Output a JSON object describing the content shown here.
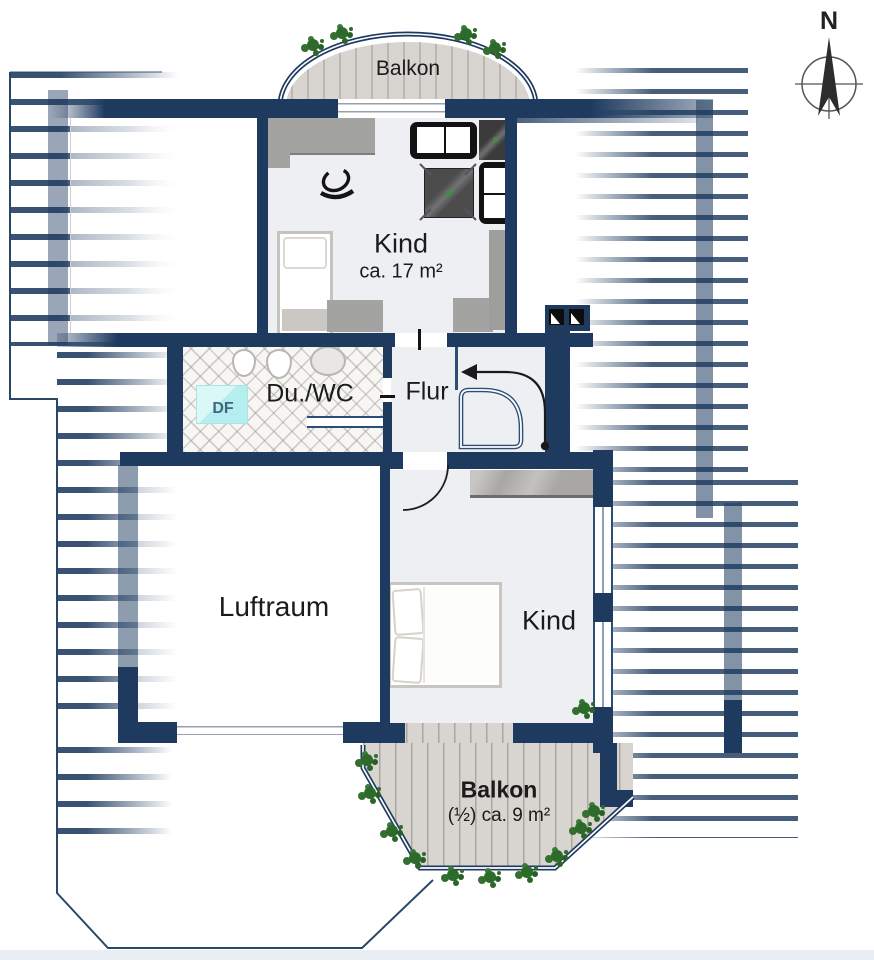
{
  "labels": {
    "balcony_top": "Balkon",
    "kind_top": "Kind",
    "kind_top_area": "ca. 17 m²",
    "du_wc": "Du./WC",
    "flur": "Flur",
    "skylight": "DF",
    "luftraum": "Luftraum",
    "kind_bottom": "Kind",
    "balcony_bottom": "Balkon",
    "balcony_bottom_area": "(½) ca. 9 m²",
    "compass_north": "N"
  },
  "colors": {
    "wall_navy": "#1e3a5f",
    "floor_light": "#edeff3",
    "wood_plank": "#d8d4d0",
    "skylight_cyan": "#c2f1f1",
    "plant_green": "#2d6b2b",
    "stair_rail_blue": "#2e4d74",
    "text_dark": "#1b1b1b"
  }
}
